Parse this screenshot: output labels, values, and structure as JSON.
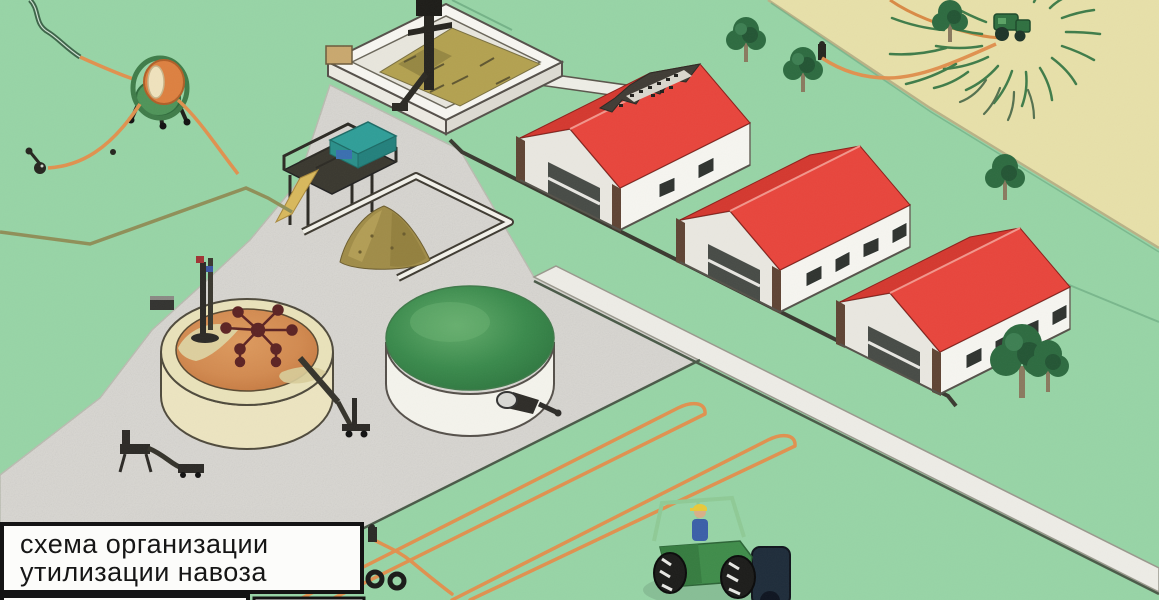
{
  "title_plate": {
    "line1": "схема организации",
    "line2": "утилизации навоза"
  },
  "scene": {
    "type": "isometric farm manure utilization scheme",
    "palette": {
      "pasture_green": "#97d4a6",
      "cropland_tan": "#e7e0a9",
      "farmyard_grey": "#d8d6d1",
      "road_grey": "#edece6",
      "barn_roof_red": "#e8453c",
      "barn_wall_white": "#f4f3ee",
      "slurry_orange": "#d28a50",
      "dome_green": "#35814a",
      "hose_orange": "#e0914f",
      "manure_olive": "#a3914c"
    },
    "elements": [
      {
        "name": "barn-1",
        "desc": "livestock barn with red roof and cutaway showing animals"
      },
      {
        "name": "barn-2",
        "desc": "livestock barn with red roof"
      },
      {
        "name": "barn-3",
        "desc": "livestock barn with red roof"
      },
      {
        "name": "reception-pit",
        "desc": "manure reception pit with pump mast"
      },
      {
        "name": "separator-unit",
        "desc": "separator machine on elevated platform"
      },
      {
        "name": "solids-pile",
        "desc": "separated solid manure pile in walled bay"
      },
      {
        "name": "open-slurry-tank",
        "desc": "open slurry storage tank with mixer and pumps"
      },
      {
        "name": "covered-slurry-tank",
        "desc": "green-domed covered storage tank with pump"
      },
      {
        "name": "hose-reel-irrigator",
        "desc": "hose reel with orange hose and sprinkler"
      },
      {
        "name": "field-tractor-spreading",
        "desc": "tractor spreading slurry on cropland"
      },
      {
        "name": "yard-tractor",
        "desc": "tractor with driver on lower field"
      },
      {
        "name": "irrigation-hoses",
        "desc": "orange drag hoses with hairpin loops"
      },
      {
        "name": "pipeline",
        "desc": "pipeline with hydrants"
      },
      {
        "name": "trees",
        "desc": "scattered trees"
      }
    ]
  }
}
